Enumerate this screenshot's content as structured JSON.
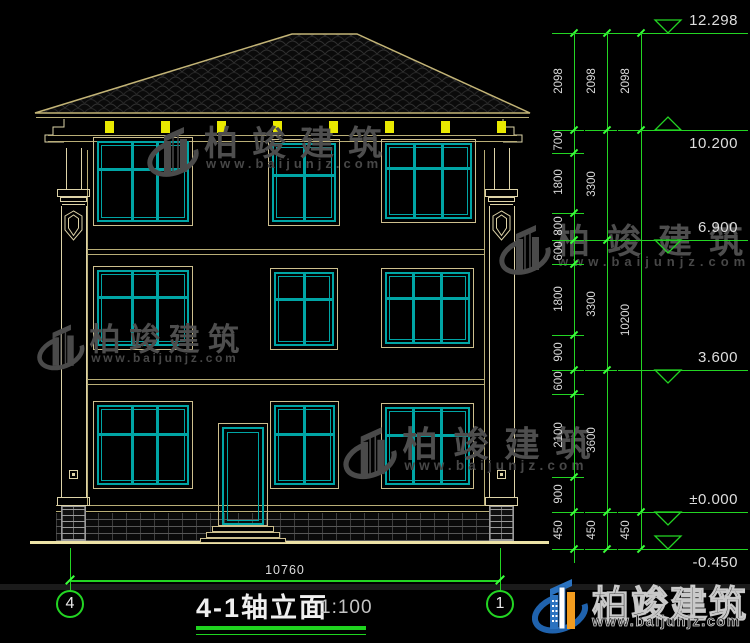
{
  "title_block": {
    "name": "4-1轴立面",
    "scale": "1:100"
  },
  "axes": {
    "left": "4",
    "right": "1"
  },
  "brand": {
    "name": "柏竣建筑",
    "site": "www.baijunjz.com"
  },
  "dimensions": {
    "bottom_total": "10760",
    "right_columns": [
      {
        "id": "inner",
        "x": 574,
        "extend": 14,
        "segments": [
          [
            "2098",
            33,
            130
          ],
          [
            "700",
            130,
            153
          ],
          [
            "1800",
            153,
            213
          ],
          [
            "800",
            213,
            240
          ],
          [
            "600",
            240,
            264
          ],
          [
            "1800",
            264,
            335
          ],
          [
            "900",
            335,
            370
          ],
          [
            "600",
            370,
            394
          ],
          [
            "2100",
            394,
            477
          ],
          [
            "900",
            477,
            512
          ],
          [
            "450",
            512,
            549
          ]
        ]
      },
      {
        "id": "middle",
        "x": 607,
        "extend": 0,
        "segments": [
          [
            "2098",
            33,
            130
          ],
          [
            "3300",
            130,
            240
          ],
          [
            "3300",
            240,
            370
          ],
          [
            "3600",
            370,
            512
          ],
          [
            "450",
            512,
            549
          ]
        ]
      },
      {
        "id": "outer",
        "x": 641,
        "extend": 0,
        "segments": [
          [
            "2098",
            33,
            130
          ],
          [
            "10200",
            130,
            512
          ],
          [
            "450",
            512,
            549
          ]
        ]
      }
    ],
    "elevations": [
      {
        "label": "12.298",
        "y": 33,
        "marker": "down-above",
        "text_pos": "above",
        "x0": 552
      },
      {
        "label": "10.200",
        "y": 130,
        "marker": "up-above",
        "text_pos": "below"
      },
      {
        "label": "6.900",
        "y": 240,
        "marker": "down-below",
        "text_pos": "above"
      },
      {
        "label": "3.600",
        "y": 370,
        "marker": "down-below",
        "text_pos": "above"
      },
      {
        "label": "±0.000",
        "y": 512,
        "marker": "down-below",
        "text_pos": "above"
      },
      {
        "label": "-0.450",
        "y": 549,
        "marker": "down-above",
        "text_pos": "below"
      }
    ]
  },
  "windows": [
    {
      "x": 93,
      "y": 137,
      "w": 100,
      "h": 89,
      "cols": [
        0.38,
        0.66
      ],
      "rail": 0.35
    },
    {
      "x": 268,
      "y": 139,
      "w": 72,
      "h": 87,
      "cols": [
        0.5
      ],
      "rail": 0.4
    },
    {
      "x": 381,
      "y": 139,
      "w": 95,
      "h": 84,
      "cols": [
        0.33,
        0.67
      ],
      "rail": 0.33
    },
    {
      "x": 93,
      "y": 266,
      "w": 100,
      "h": 84,
      "cols": [
        0.38,
        0.66
      ],
      "rail": 0.36
    },
    {
      "x": 270,
      "y": 268,
      "w": 68,
      "h": 82,
      "cols": [
        0.5
      ],
      "rail": 0.37
    },
    {
      "x": 381,
      "y": 268,
      "w": 93,
      "h": 80,
      "cols": [
        0.33,
        0.67
      ],
      "rail": 0.36
    },
    {
      "x": 93,
      "y": 401,
      "w": 100,
      "h": 88,
      "cols": [
        0.38,
        0.66
      ],
      "rail": 0.36
    },
    {
      "x": 270,
      "y": 401,
      "w": 69,
      "h": 88,
      "cols": [
        0.5
      ],
      "rail": 0.36
    },
    {
      "x": 381,
      "y": 403,
      "w": 93,
      "h": 86,
      "cols": [
        0.33,
        0.67
      ],
      "rail": 0.36
    }
  ],
  "door": {
    "x": 218,
    "y": 423,
    "w": 50,
    "h": 103
  },
  "watermarks": [
    {
      "x": 146,
      "y": 120,
      "s": 1.0,
      "ls": 14,
      "ws": 4
    },
    {
      "x": 36,
      "y": 318,
      "s": 0.92,
      "ls": 9,
      "ws": 3
    },
    {
      "x": 498,
      "y": 218,
      "s": 1.0,
      "ls": 17,
      "ws": 5
    },
    {
      "x": 342,
      "y": 420,
      "s": 1.04,
      "ls": 15,
      "ws": 4
    }
  ],
  "colors": {
    "green": "#23d523",
    "tick_green": "#3aff3a",
    "teal": "#00a5a5",
    "trim": "#cdbf8e",
    "roof_line": "#c3b476",
    "cream": "#b9ae77",
    "pilaster": "#ddd3a8",
    "yellow": "#e9e900",
    "ground": "#ece2a6",
    "dim_text": "#d8d8d8",
    "watermark": "#4e4e4e",
    "logo_blue": "#1f62ad",
    "logo_orange": "#f29c1f"
  }
}
